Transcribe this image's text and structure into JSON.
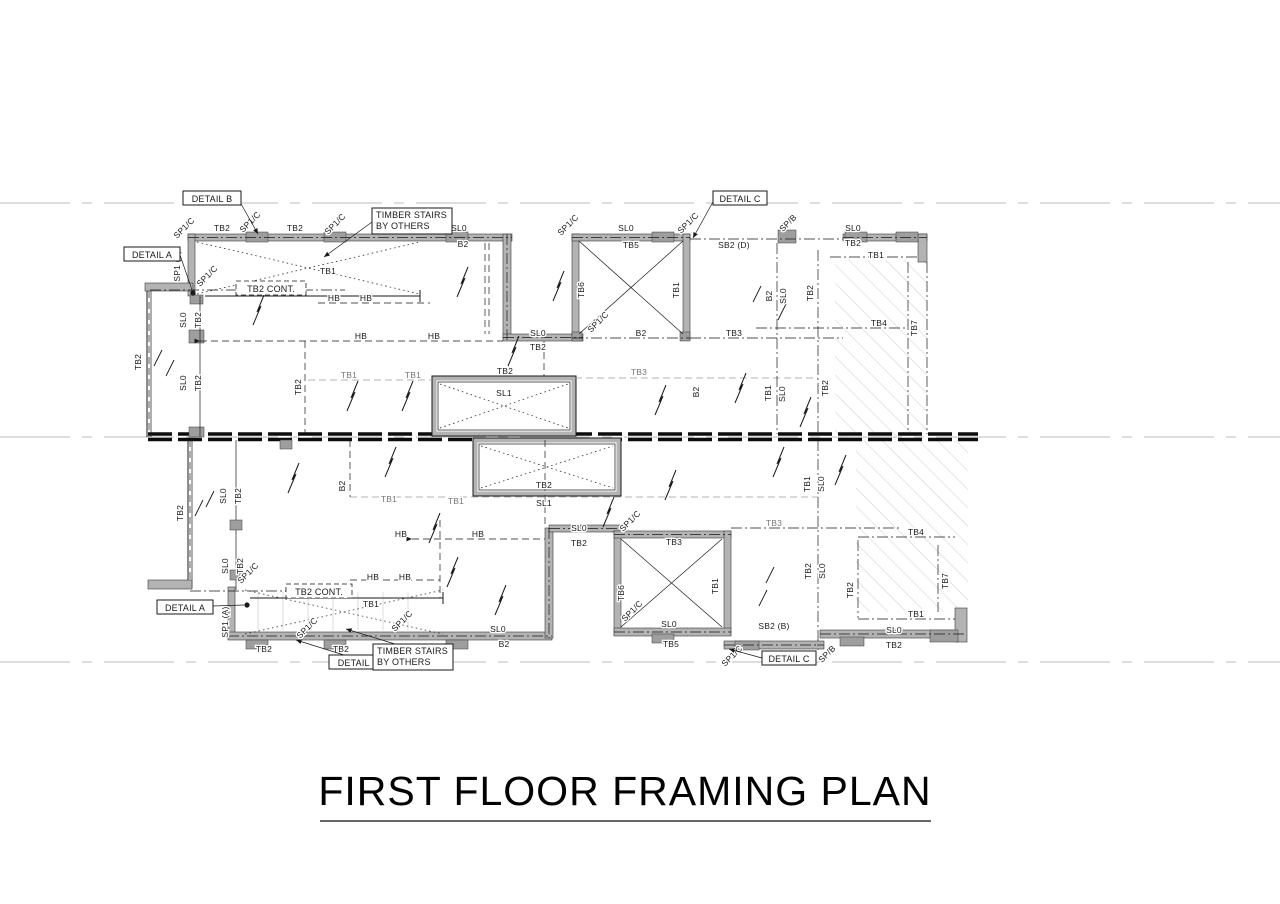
{
  "title": {
    "text": "FIRST FLOOR FRAMING PLAN"
  },
  "callouts": {
    "detail_a": "DETAIL A",
    "detail_b": "DETAIL B",
    "detail_c": "DETAIL C",
    "timber_stairs_line1": "TIMBER STAIRS",
    "timber_stairs_line2": "BY OTHERS",
    "tb2_cont": "TB2 CONT."
  },
  "lbl": {
    "tb1": "TB1",
    "tb2": "TB2",
    "tb3": "TB3",
    "tb4": "TB4",
    "tb5": "TB5",
    "tb6": "TB6",
    "tb7": "TB7",
    "b2": "B2",
    "hb": "HB",
    "sl0": "SL0",
    "sl1": "SL1",
    "sp1c": "SP1/C",
    "spb": "SP/B",
    "sp1a": "SP1 (A)",
    "sb2d": "SB2 (D)",
    "sb2b": "SB2 (B)"
  },
  "colors": {
    "line": "#1a1a1a",
    "wall_fill": "#b3b3b3",
    "grey_label": "#777777",
    "hatch": "#d4d4d4",
    "faint_line": "#bdbdbd",
    "background": "#ffffff"
  }
}
